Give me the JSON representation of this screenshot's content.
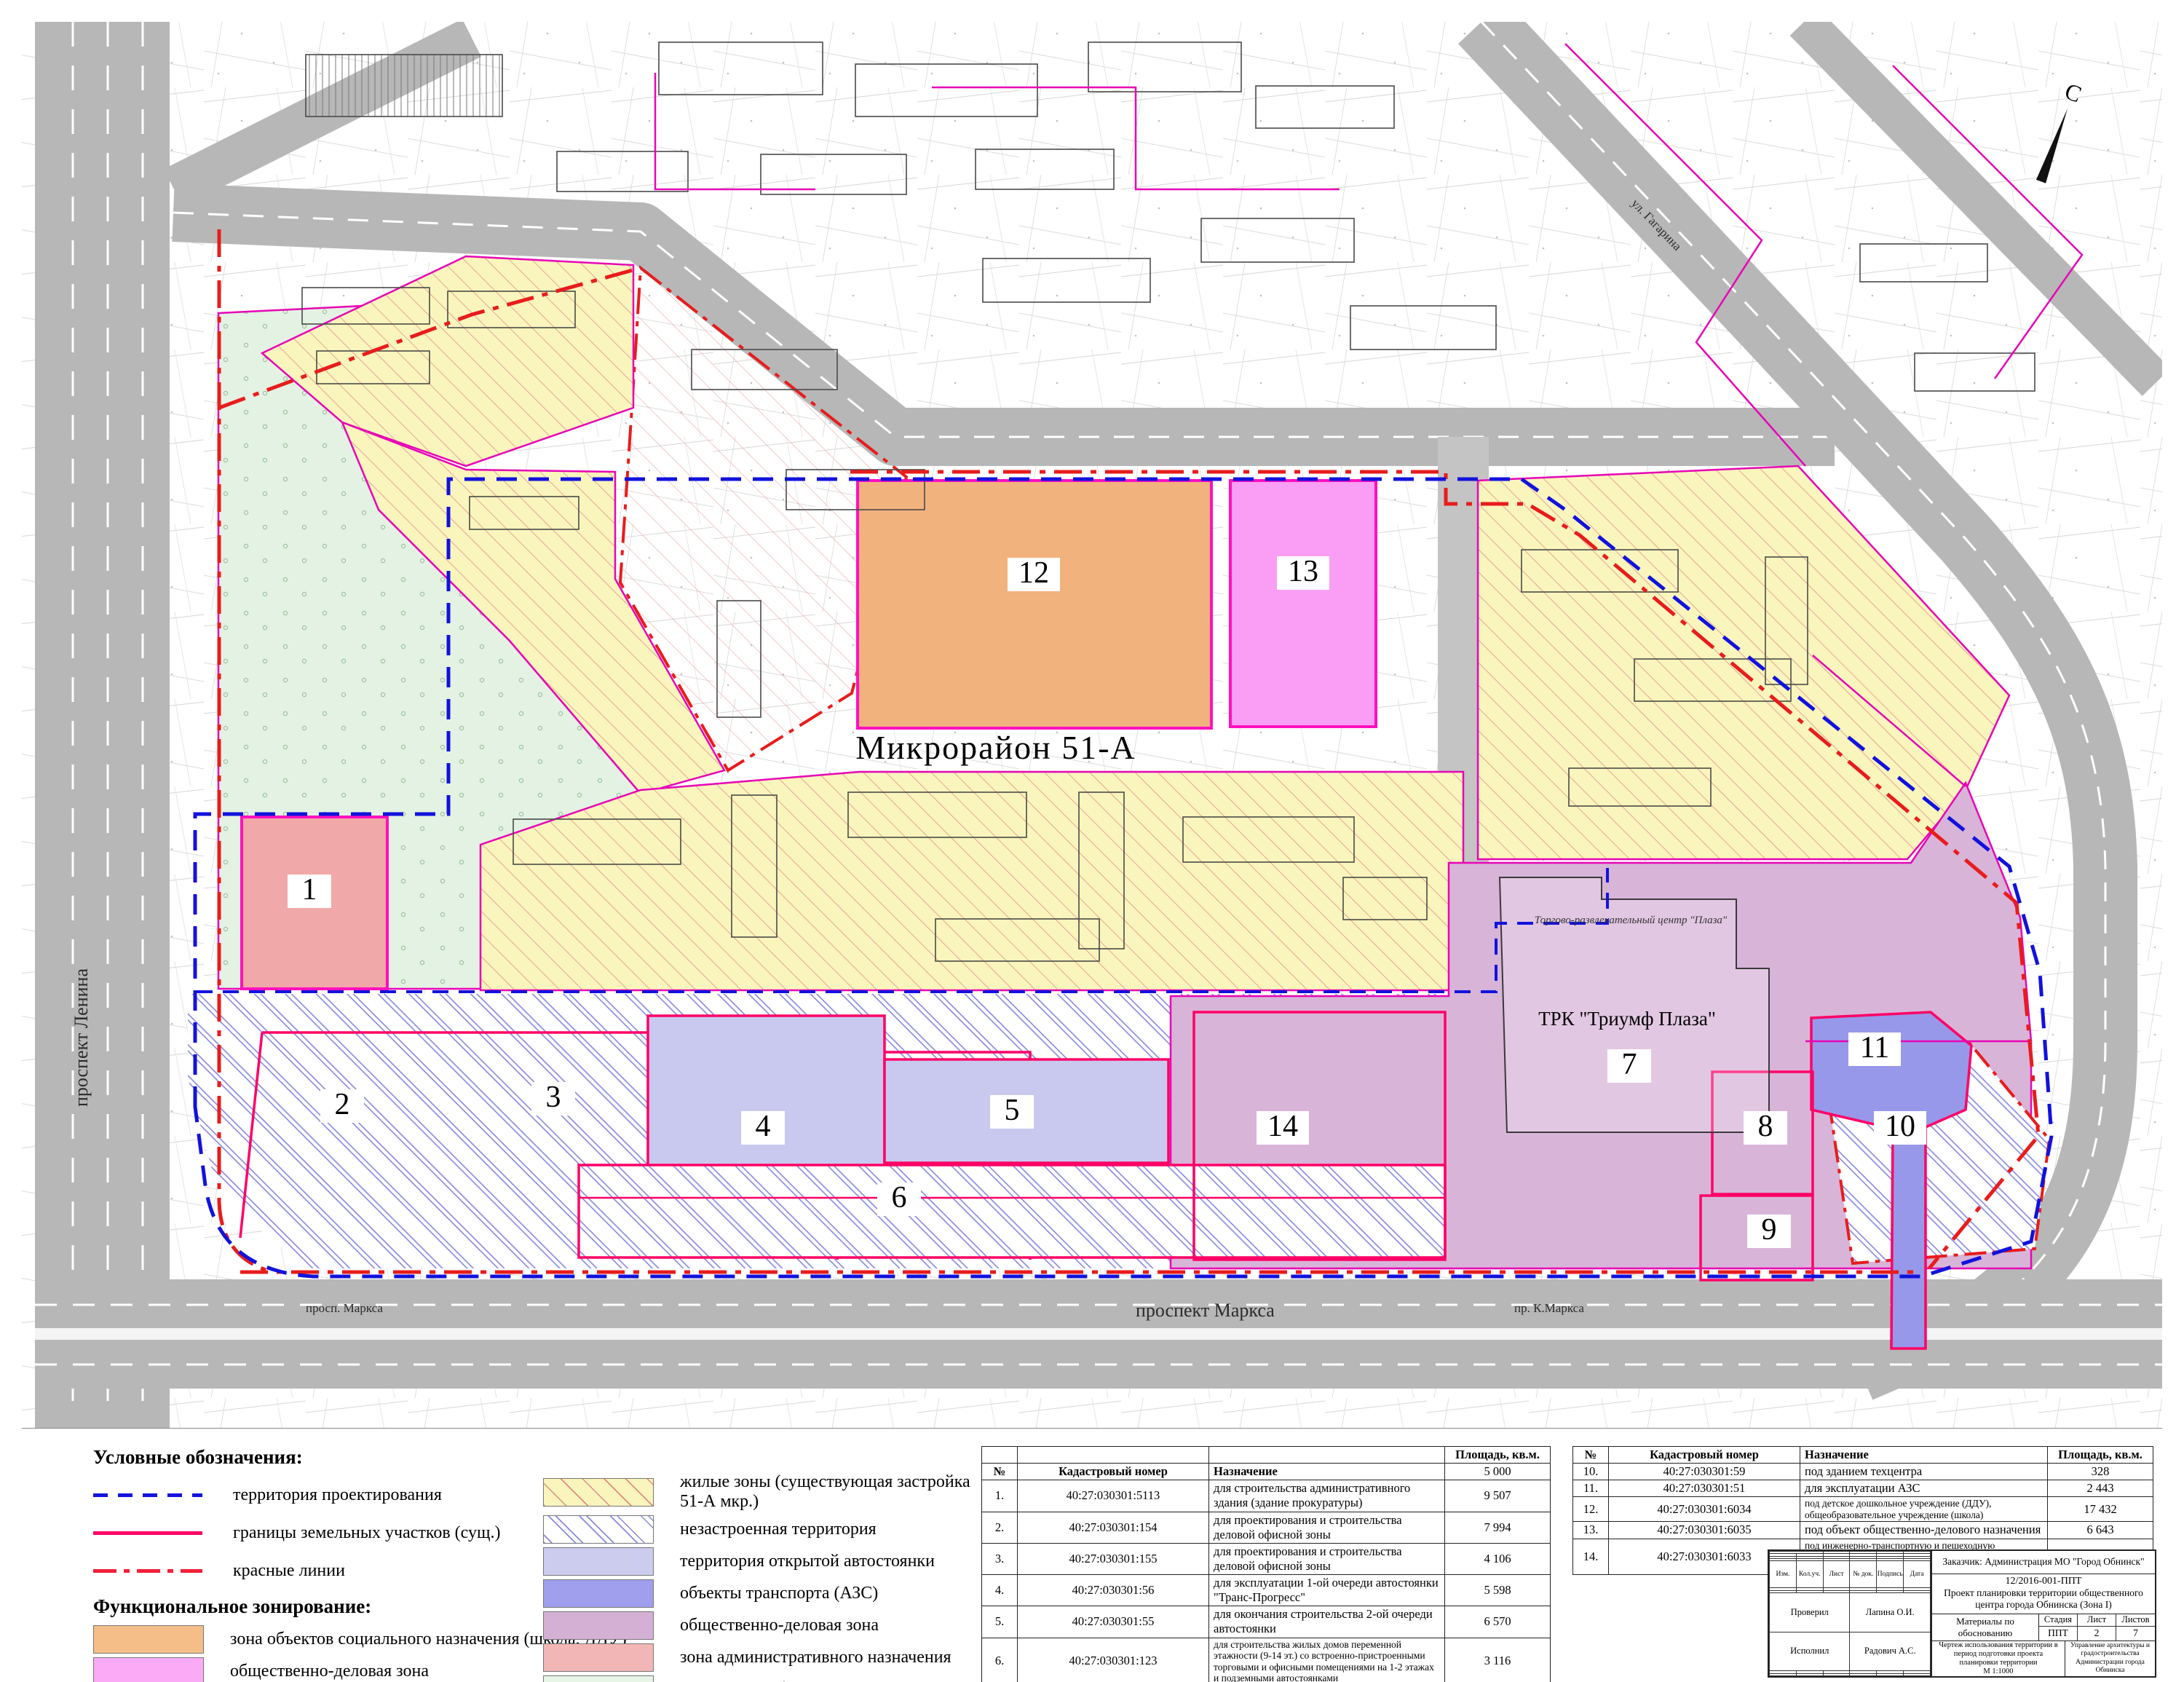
{
  "map": {
    "district_label": "Микрорайон 51-А",
    "mall_label": "ТРК \"Триумф Плаза\"",
    "mall_sub_label": "Торгово-развлекательный центр \"Плаза\"",
    "north_label": "С",
    "zone_numbers": [
      "1",
      "2",
      "3",
      "4",
      "5",
      "6",
      "7",
      "8",
      "9",
      "10",
      "11",
      "12",
      "13",
      "14"
    ],
    "streets": {
      "lenina": "проспект Ленина",
      "marksa_main": "проспект Маркса",
      "marksa_small": "просп. Маркса",
      "k_marksa": "пр. К.Маркса",
      "gagarina": "ул. Гагарина"
    }
  },
  "legend": {
    "title": "Условные обозначения:",
    "line_items": [
      {
        "label": "территория проектирования"
      },
      {
        "label": "границы земельных участков (сущ.)"
      },
      {
        "label": "красные линии"
      }
    ],
    "zoning_title": "Функциональное зонирование:",
    "zoning_items_left": [
      {
        "label": "зона объектов социального назначения (школа, ДДУ)"
      },
      {
        "label": "общественно-деловая зона"
      }
    ],
    "zoning_items_right": [
      {
        "label": "жилые зоны (существующая застройка 51-А мкр.)"
      },
      {
        "label": "незастроенная территория"
      },
      {
        "label": "территория открытой автостоянки"
      },
      {
        "label": "объекты транспорта (АЗС)"
      },
      {
        "label": "общественно-деловая зона"
      },
      {
        "label": "зона административного назначения"
      },
      {
        "label": "озеленение общего пользования"
      }
    ]
  },
  "tables": {
    "left": {
      "pre_header": [
        "",
        "",
        "",
        "Площадь, кв.м."
      ],
      "header": [
        "№",
        "Кадастровый номер",
        "Назначение",
        "5 000"
      ],
      "rows": [
        [
          "1.",
          "40:27:030301:5113",
          "для строительства административного здания (здание прокуратуры)",
          "9 507"
        ],
        [
          "2.",
          "40:27:030301:154",
          "для проектирования и строительства деловой офисной зоны",
          "7 994"
        ],
        [
          "3.",
          "40:27:030301:155",
          "для проектирования и строительства деловой офисной зоны",
          "4 106"
        ],
        [
          "4.",
          "40:27:030301:56",
          "для эксплуатации 1-ой очереди автостоянки \"Транс-Прогресс\"",
          "5 598"
        ],
        [
          "5.",
          "40:27:030301:55",
          "для окончания строительства 2-ой очереди автостоянки",
          "6 570"
        ],
        [
          "6.",
          "40:27:030301:123",
          "для строительства жилых домов переменной этажности (9-14 эт.) со встроенно-пристроенными торговыми и офисными помещениями на 1-2 этажах и подземными автостоянками",
          "3 116"
        ],
        [
          "7.",
          "40:27:030301:113",
          "объекты торговли, общественного питания, бытового обслуживания общей площадью свыше 800 кв.м.",
          "37 420"
        ],
        [
          "8.",
          "40:27:030301:111",
          "под замощением (автостоянкой)",
          "2 784"
        ],
        [
          "9.",
          "40:27:030301:58",
          "для эксплуатации кафе бара \"Лагуна\"",
          "342"
        ]
      ]
    },
    "right": {
      "header": [
        "№",
        "Кадастровый номер",
        "Назначение",
        "Площадь, кв.м."
      ],
      "rows": [
        [
          "10.",
          "40:27:030301:59",
          "под зданием техцентра",
          "328"
        ],
        [
          "11.",
          "40:27:030301:51",
          "для эксплуатации АЗС",
          "2 443"
        ],
        [
          "12.",
          "40:27:030301:6034",
          "под детское дошкольное учреждение (ДДУ), общеобразовательное учреждение (школа)",
          "17 432"
        ],
        [
          "13.",
          "40:27:030301:6035",
          "под объект общественно-делового назначения",
          "6 643"
        ],
        [
          "14.",
          "40:27:030301:6033",
          "под инженерно-транспортную и пешеходную инфраструктуру городской площади, под детские площадки",
          "7 322"
        ]
      ]
    }
  },
  "title_block": {
    "customer": "Заказчик: Администрация МО \"Город Обнинск\"",
    "doc_number": "12/2016-001-ППТ",
    "project_line1": "Проект планировки территории общественного",
    "project_line2": "центра города Обнинска (Зона I)",
    "columns": [
      "Изм.",
      "Кол.уч.",
      "Лист",
      "№ док.",
      "Подпись",
      "Дата"
    ],
    "checked_label": "Проверил",
    "checked_name": "Лапина О.И.",
    "author_label": "Исполнил",
    "author_name": "Радович А.С.",
    "materials": "Материалы по обоснованию",
    "stage_label": "Стадия",
    "sheet_label": "Лист",
    "sheets_label": "Листов",
    "stage_value": "ППТ",
    "sheet_value": "2",
    "sheets_value": "7",
    "drawing_title": "Чертеж использования территории в период подготовки проекта планировки территории",
    "scale": "М 1:1000",
    "organization": "Управление архитектуры и градостроительства Администрации города Обнинска"
  },
  "colors": {
    "project_boundary": "#1212dd",
    "parcel_boundary": "#ff0066",
    "red_lines": "#e81c1c",
    "zone_social": "#f5bd88",
    "zone_business_pink": "#fbaaf6",
    "zone_residential": "#faf5bc",
    "zone_parking": "#ccccee",
    "zone_transport": "#9f9fee",
    "zone_business_purple": "#d5b0d5",
    "zone_admin": "#f3b6b6",
    "zone_green": "#e7f5e7"
  }
}
